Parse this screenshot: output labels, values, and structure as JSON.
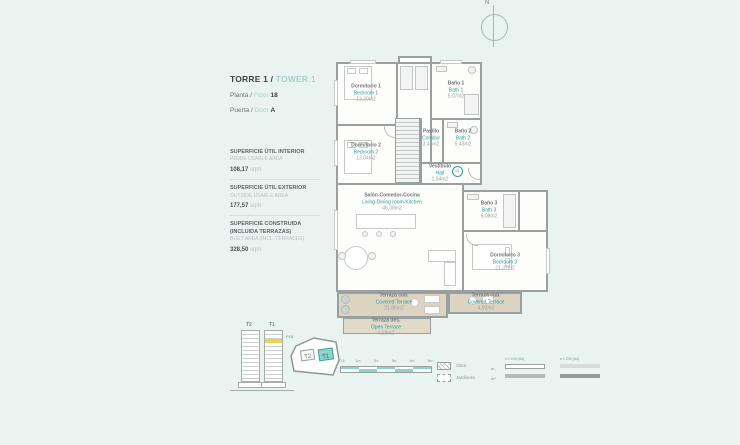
{
  "header": {
    "torre": "TORRE 1 /",
    "tower": "TOWER 1",
    "planta": "Planta /",
    "floor": "Floor",
    "floor_num": "18",
    "puerta": "Puerta /",
    "door": "Door",
    "door_letter": "A"
  },
  "areas": [
    {
      "es": "SUPERFICIE ÚTIL INTERIOR",
      "en": "INSIDE USABLE AREA",
      "value": "108,17",
      "unit": "sqm"
    },
    {
      "es": "SUPERFICIE ÚTIL EXTERIOR",
      "en": "OUTSIDE USABLE AREA",
      "value": "177,57",
      "unit": "sqm"
    },
    {
      "es": "SUPERFICIE CONSTRUIDA (INCLUIDA TERRAZAS)",
      "en": "BUILT AREA (INCL. TERRACES)",
      "value": "328,50",
      "unit": "sqm"
    }
  ],
  "compass": {
    "label": "N"
  },
  "rooms": [
    {
      "es": "Dormitorio 1",
      "en": "Bedroom 1",
      "area": "13,20m2"
    },
    {
      "es": "Baño 1",
      "en": "Bath 1",
      "area": "5,07m2"
    },
    {
      "es": "Dormitorio 2",
      "en": "Bedroom 2",
      "area": "13,04m2"
    },
    {
      "es": "Pasillo",
      "en": "Corridor",
      "area": "3,48m2"
    },
    {
      "es": "Baño 2",
      "en": "Bath 2",
      "area": "5,43m2"
    },
    {
      "es": "Vestíbulo",
      "en": "Hall",
      "area": "1,54m2"
    },
    {
      "es": "Salón-Comedor-Cocina",
      "en": "Living-Dining room-Kitchen",
      "area": "46,38m2"
    },
    {
      "es": "Baño 3",
      "en": "Bath 3",
      "area": "5,08m2"
    },
    {
      "es": "Dormitorio 3",
      "en": "Bedroom 3",
      "area": "21,37m2"
    },
    {
      "es": "Terraza cub.",
      "en": "Covered Terrace",
      "area": "21,86m2"
    },
    {
      "es": "Terraza des.",
      "en": "Open Terrace",
      "area": "4,59m2"
    },
    {
      "es": "Terraza cub.",
      "en": "Covered Terrace",
      "area": "4,92m2"
    }
  ],
  "entry_badge": "01",
  "towers": {
    "t2": "T2",
    "t1": "T1",
    "floor_tag": "P18"
  },
  "siteplan": {
    "t2": "T2",
    "t1": "T1"
  },
  "scalebar": {
    "ticks": [
      "0,5",
      "1m",
      "2m",
      "3m",
      "4m",
      "5m"
    ]
  },
  "legend": {
    "obra": "Obra",
    "jardinera": "Jardinera",
    "row1": "m.",
    "row2": "m²",
    "a3": "e 1:100 (A3)",
    "a4": "e 1:200 (A4)"
  },
  "colors": {
    "background": "#e9f4f1",
    "accent": "#2f9d99",
    "terrace": "#dcd3c0",
    "wall": "#99a09f",
    "floor_highlight": "#f0d14e"
  }
}
